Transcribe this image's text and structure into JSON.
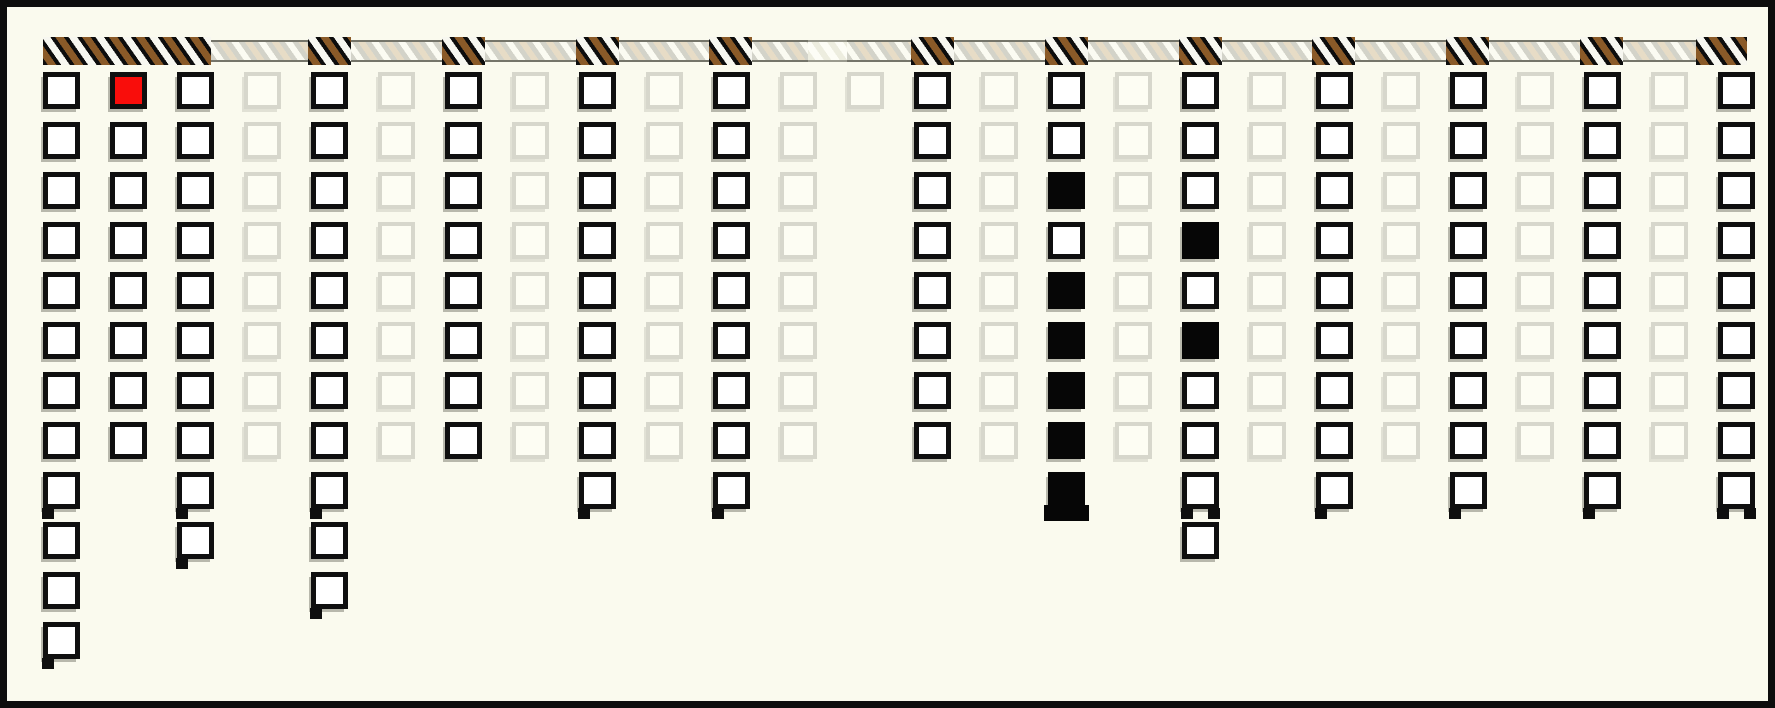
{
  "window": {
    "width": 1775,
    "height": 708,
    "background_color": "#fafaee",
    "border_color": "#0d0d0d",
    "border_px": 7
  },
  "palette": {
    "cell_outline": "#0f0f0f",
    "cell_fill_white": "#ffffff",
    "cell_faded_outline": "#d7d7cc",
    "cell_faded_fill": "#fdfdf3",
    "cell_red": "#f90d0b",
    "cell_black": "#060606",
    "bar_dark_bg": "#0d0d0d",
    "bar_stripe_brown": "#8a5a28",
    "bar_stripe_white": "#f7f7f0",
    "bar_light_bg": "#d3d3c9",
    "bar_light_stripe_tan": "#e7dcc6",
    "bar_white_bg": "#ededdf"
  },
  "track_bar": {
    "y": 30,
    "height": 28,
    "segment_types_legend": {
      "dark": "black block with brown/white diagonal hatching",
      "light": "gray strip with white/tan diagonal hatching",
      "white": "pale strip with faint white hatching"
    },
    "segments": [
      {
        "type": "dark",
        "x": 36,
        "w": 168
      },
      {
        "type": "light",
        "x": 204,
        "w": 97
      },
      {
        "type": "dark",
        "x": 301,
        "w": 43
      },
      {
        "type": "light",
        "x": 344,
        "w": 91
      },
      {
        "type": "dark",
        "x": 435,
        "w": 43
      },
      {
        "type": "light",
        "x": 478,
        "w": 91
      },
      {
        "type": "dark",
        "x": 569,
        "w": 43
      },
      {
        "type": "light",
        "x": 612,
        "w": 90
      },
      {
        "type": "dark",
        "x": 702,
        "w": 43
      },
      {
        "type": "light",
        "x": 745,
        "w": 56
      },
      {
        "type": "white",
        "x": 801,
        "w": 39
      },
      {
        "type": "light",
        "x": 840,
        "w": 64
      },
      {
        "type": "dark",
        "x": 904,
        "w": 43
      },
      {
        "type": "light",
        "x": 947,
        "w": 91
      },
      {
        "type": "dark",
        "x": 1038,
        "w": 43
      },
      {
        "type": "light",
        "x": 1081,
        "w": 91
      },
      {
        "type": "dark",
        "x": 1172,
        "w": 43
      },
      {
        "type": "light",
        "x": 1215,
        "w": 90
      },
      {
        "type": "dark",
        "x": 1305,
        "w": 43
      },
      {
        "type": "light",
        "x": 1348,
        "w": 91
      },
      {
        "type": "dark",
        "x": 1439,
        "w": 43
      },
      {
        "type": "light",
        "x": 1482,
        "w": 91
      },
      {
        "type": "dark",
        "x": 1573,
        "w": 43
      },
      {
        "type": "light",
        "x": 1616,
        "w": 73
      },
      {
        "type": "dark",
        "x": 1689,
        "w": 51
      }
    ]
  },
  "board": {
    "origin_x": 36,
    "origin_y": 65,
    "col_spacing": 67,
    "row_spacing": 50,
    "cell_size": 37,
    "cell_states_legend": {
      "W": "white cell, bold black outline",
      "L": "faded cell, light gray outline",
      "R": "red filled cell, black outline",
      "B": "black filled cell"
    },
    "columns": [
      {
        "index": 1,
        "cells": "WWWWWWWWWWWW"
      },
      {
        "index": 2,
        "cells": "RWWWWWWW"
      },
      {
        "index": 3,
        "cells": "WWWWWWWWWW"
      },
      {
        "index": 4,
        "cells": "LLLLLLLL"
      },
      {
        "index": 5,
        "cells": "WWWWWWWWWWW"
      },
      {
        "index": 6,
        "cells": "LLLLLLLL"
      },
      {
        "index": 7,
        "cells": "WWWWWWWW"
      },
      {
        "index": 8,
        "cells": "LLLLLLLL"
      },
      {
        "index": 9,
        "cells": "WWWWWWWWW"
      },
      {
        "index": 10,
        "cells": "LLLLLLLL"
      },
      {
        "index": 11,
        "cells": "WWWWWWWWW"
      },
      {
        "index": 12,
        "cells": "LLLLLLLL"
      },
      {
        "index": 13,
        "cells": "L"
      },
      {
        "index": 14,
        "cells": "WWWWWWWW"
      },
      {
        "index": 15,
        "cells": "LLLLLLLL"
      },
      {
        "index": 16,
        "cells": "WWBWBBBBB"
      },
      {
        "index": 17,
        "cells": "LLLLLLLL"
      },
      {
        "index": 18,
        "cells": "WWWBWBWWWW"
      },
      {
        "index": 19,
        "cells": "LLLLLLLL"
      },
      {
        "index": 20,
        "cells": "WWWWWWWWW"
      },
      {
        "index": 21,
        "cells": "LLLLLLLL"
      },
      {
        "index": 22,
        "cells": "WWWWWWWWW"
      },
      {
        "index": 23,
        "cells": "LLLLLLLL"
      },
      {
        "index": 24,
        "cells": "WWWWWWWWW"
      },
      {
        "index": 25,
        "cells": "LLLLLLLL"
      },
      {
        "index": 26,
        "cells": "WWWWWWWWW"
      }
    ],
    "stub_artifacts": [
      {
        "col": 1,
        "row": 9,
        "type": "left"
      },
      {
        "col": 3,
        "row": 9,
        "type": "left"
      },
      {
        "col": 5,
        "row": 9,
        "type": "left"
      },
      {
        "col": 9,
        "row": 9,
        "type": "left"
      },
      {
        "col": 11,
        "row": 9,
        "type": "left"
      },
      {
        "col": 16,
        "row": 9,
        "type": "wide"
      },
      {
        "col": 18,
        "row": 9,
        "type": "both"
      },
      {
        "col": 20,
        "row": 9,
        "type": "left"
      },
      {
        "col": 22,
        "row": 9,
        "type": "left"
      },
      {
        "col": 24,
        "row": 9,
        "type": "left"
      },
      {
        "col": 26,
        "row": 9,
        "type": "both"
      },
      {
        "col": 3,
        "row": 10,
        "type": "left"
      },
      {
        "col": 5,
        "row": 11,
        "type": "left"
      },
      {
        "col": 1,
        "row": 12,
        "type": "left"
      }
    ]
  }
}
